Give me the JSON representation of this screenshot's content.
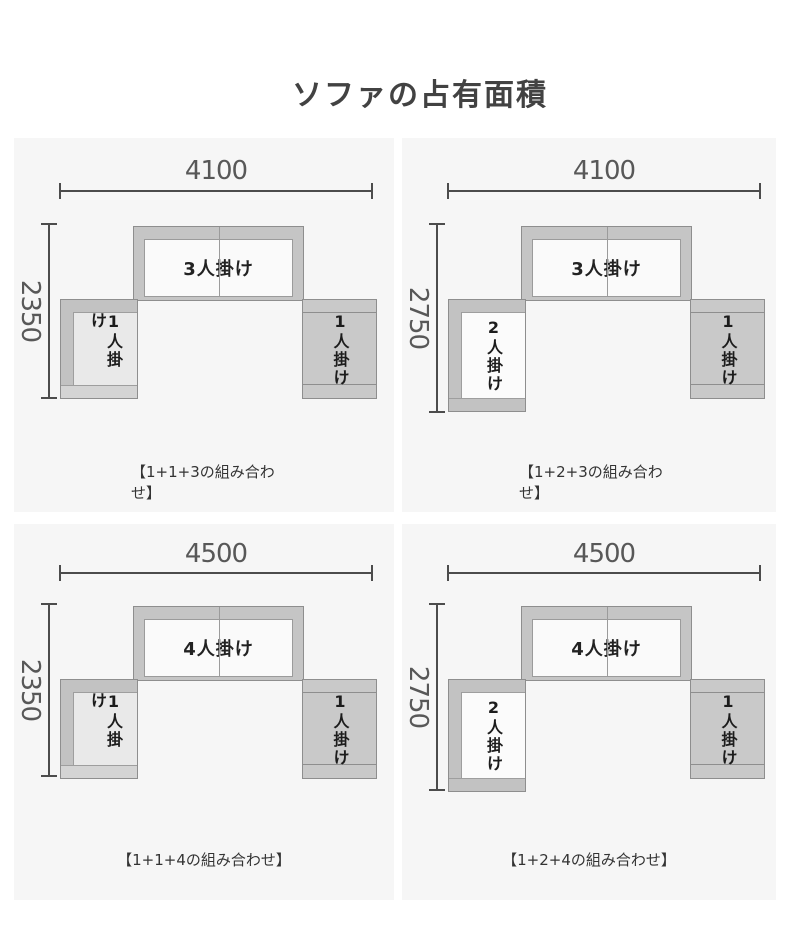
{
  "title": "ソファの占有面積",
  "panels": [
    {
      "width_label": "4100",
      "height_label": "2350",
      "center_label": "3人掛け",
      "left_label": "1人掛け",
      "right_label": "1人掛け",
      "caption": "【1+1+3の組み合わせ】"
    },
    {
      "width_label": "4100",
      "height_label": "2750",
      "center_label": "3人掛け",
      "left_label": "2人掛け",
      "right_label": "1人掛け",
      "caption": "【1+2+3の組み合わせ】"
    },
    {
      "width_label": "4500",
      "height_label": "2350",
      "center_label": "4人掛け",
      "left_label": "1人掛け",
      "right_label": "1人掛け",
      "caption": "【1+1+4の組み合わせ】"
    },
    {
      "width_label": "4500",
      "height_label": "2750",
      "center_label": "4人掛け",
      "left_label": "2人掛け",
      "right_label": "1人掛け",
      "caption": "【1+2+4の組み合わせ】"
    }
  ],
  "colors": {
    "page_bg": "#ffffff",
    "panel_bg": "#f6f6f6",
    "dimension_line": "#4c4c4c",
    "dimension_text": "#585858",
    "sofa_frame": "#c5c5c5",
    "sofa_seat": "#fafafa",
    "sofa_outline": "#8e8e8e",
    "seat_label_text": "#1c1c1c",
    "title_text": "#424242",
    "caption_text": "#333333"
  }
}
